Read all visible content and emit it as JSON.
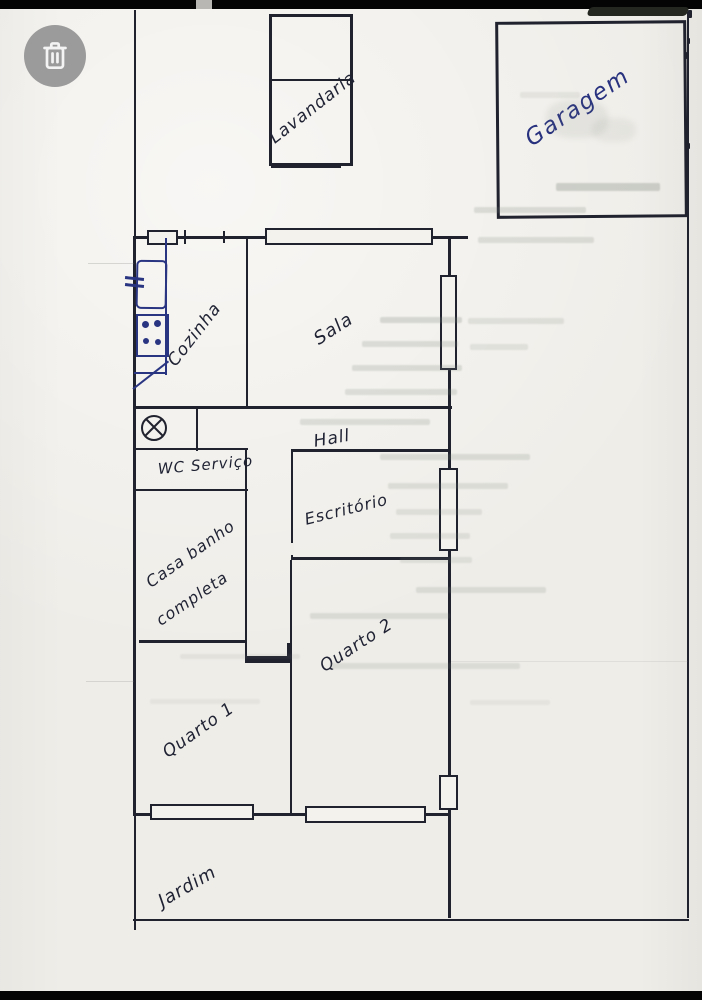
{
  "viewer": {
    "delete_button": {
      "icon": "trash-icon"
    }
  },
  "floor_plan": {
    "room_labels": {
      "lavandaria": "Lavandaria",
      "garagem": "Garagem",
      "cozinha": "Cozinha",
      "sala": "Sala",
      "hall": "Hall",
      "wc_servico": "WC Serviço",
      "escritorio": "Escritório",
      "casa_banho_line1": "Casa banho",
      "casa_banho_line2": "completa",
      "quarto_2": "Quarto 2",
      "quarto_1": "Quarto 1",
      "jardim": "Jardim"
    },
    "symbols": [
      "window",
      "sink",
      "stove",
      "ceiling-light"
    ],
    "colors": {
      "ink": "#1f2233",
      "blue_ink": "#2a3582",
      "paper": "#efede8",
      "delete_button_gray": "#9b9b9b"
    }
  }
}
